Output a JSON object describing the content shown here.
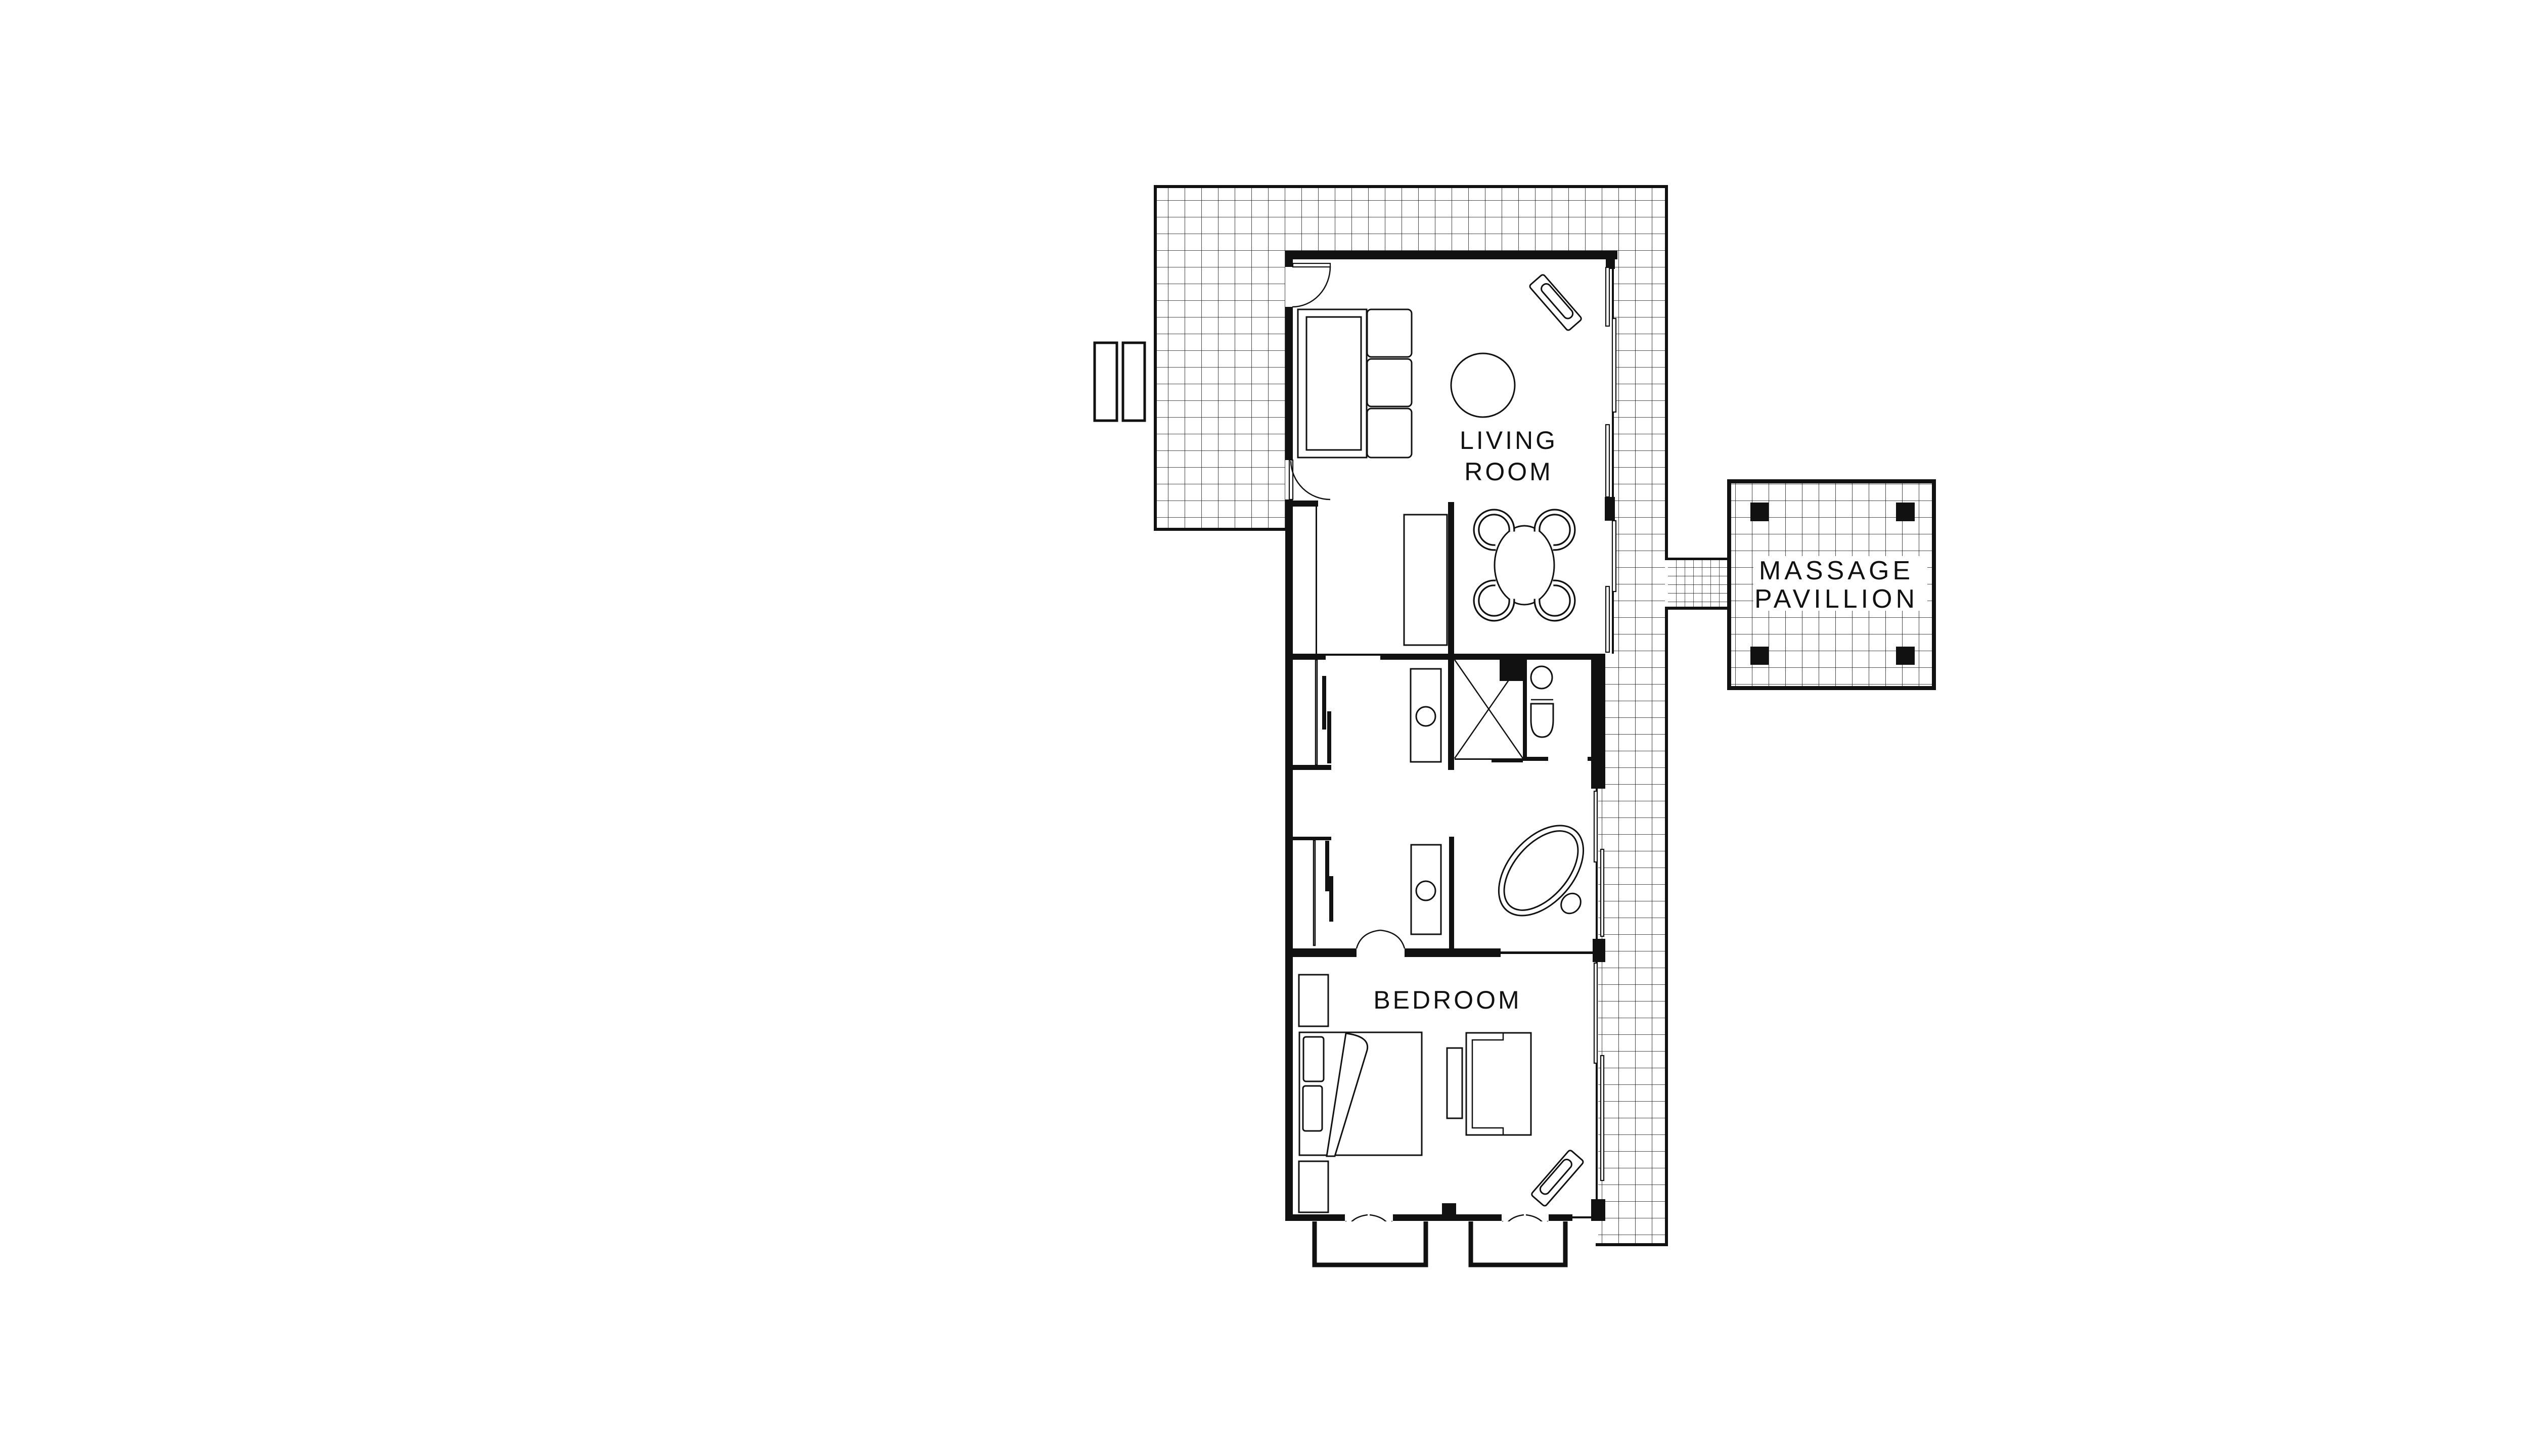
{
  "document": {
    "type": "architectural-floor-plan",
    "background_color": "#ffffff",
    "ink_color": "#111111",
    "deck_pattern": "square-grid-hatch"
  },
  "labels": {
    "living_room": {
      "line1": "LIVING",
      "line2": "ROOM"
    },
    "massage_pavillion": {
      "line1": "MASSAGE",
      "line2": "PAVILLION"
    },
    "bedroom": {
      "line1": "BEDROOM"
    }
  },
  "rooms": [
    {
      "name": "Living room",
      "features": [
        "sofa",
        "round rug",
        "chaise lounge",
        "console table",
        "dining table with four chairs",
        "deck door",
        "terrace door"
      ]
    },
    {
      "name": "Bathroom core",
      "features": [
        "two wardrobes",
        "two vanities with sinks",
        "shower",
        "toilet",
        "freestanding bathtub",
        "double swing doors"
      ]
    },
    {
      "name": "Bedroom",
      "features": [
        "bed with pillows",
        "two nightstands",
        "bench",
        "dresser",
        "chaise lounge",
        "two double doors to porches"
      ]
    },
    {
      "name": "Massage pavillion",
      "features": [
        "four columns",
        "gridded deck",
        "connecting walkway"
      ]
    }
  ]
}
